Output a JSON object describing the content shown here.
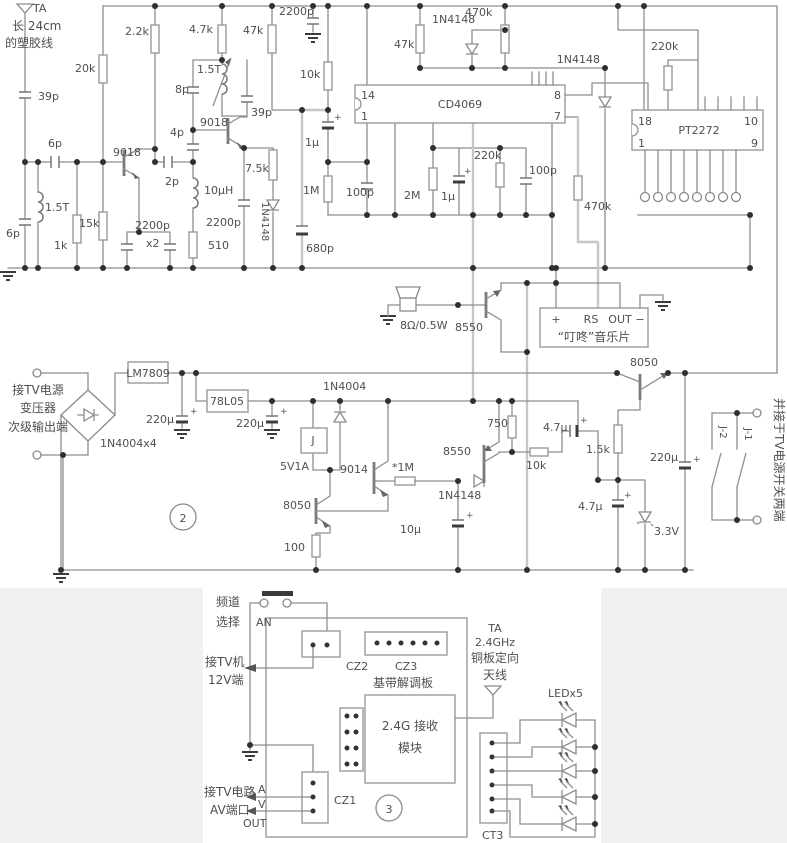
{
  "s1": {
    "ta": "TA",
    "ta2": "长 24cm",
    "ta3": "的塑胶线",
    "c39pa": "39p",
    "c6pa": "6p",
    "l15ta": "1.5T",
    "c6pb": "6p",
    "r1k": "1k",
    "r15k": "15k",
    "q9018a": "9018",
    "r20k": "20k",
    "r2k2": "2.2k",
    "c2200pa": "2200p",
    "x2": "x2",
    "c2p": "2p",
    "l10uh": "10µH",
    "r510": "510",
    "q9018b": "9018",
    "c4p": "4p",
    "c8p": "8p",
    "l15tb": "1.5T",
    "r4k7": "4.7k",
    "c39pb": "39p",
    "r47ka": "47k",
    "r7k5": "7.5k",
    "d4148d": "1N4148",
    "c2200pb": "2200p",
    "c2200pc": "2200p",
    "r10ka": "10k",
    "c1ua": "1µ",
    "r1m": "1M",
    "c680p": "680p",
    "c100pa": "100p",
    "r47kb": "47k",
    "d4148a": "1N4148",
    "r470ka": "470k",
    "ic1": "CD4069",
    "p14": "14",
    "p1": "1",
    "p8": "8",
    "p7": "7",
    "r2m": "2M",
    "c1ub": "1µ",
    "r220ka": "220k",
    "c100pb": "100p",
    "d4148b": "1N4148",
    "r470kb": "470k",
    "r220kb": "220k",
    "ic2": "PT2272",
    "p18": "18",
    "p1b": "1",
    "p10": "10",
    "p9": "9",
    "spk": "8Ω/0.5W",
    "q8550a": "8550",
    "mcp": "+",
    "mcrs": "RS",
    "mcout": "OUT",
    "mcm": "−",
    "mcname": "“叮咚”音乐片"
  },
  "s2": {
    "in1": "接TV电源",
    "in2": "变压器",
    "in3": "次级输出端",
    "bridge": "1N4004x4",
    "u1": "LM7809",
    "c220ua": "220µ",
    "u2": "78L05",
    "c220ub": "220µ",
    "num2": "2",
    "d4004": "1N4004",
    "relay": "J",
    "relayspec": "5V1A",
    "q9014": "9014",
    "r1ms": "*1M",
    "q8550b": "8550",
    "d4148c": "1N4148",
    "c10u": "10µ",
    "q8050a": "8050",
    "r100": "100",
    "r750": "750",
    "r10kb": "10k",
    "c4u7a": "4.7µ",
    "r1k5": "1.5k",
    "c220uc": "220µ",
    "c4u7b": "4.7µ",
    "dz": "3.3V",
    "q8050b": "8050",
    "j1": "J-1",
    "j2": "J-2",
    "note": "并接于TV电源开关两端"
  },
  "s3": {
    "ch1": "频道",
    "ch2": "选择",
    "an": "AN",
    "tv1": "接TV机",
    "tv2": "12V端",
    "cz2": "CZ2",
    "cz3": "CZ3",
    "board": "基带解调板",
    "mod1": "2.4G 接收",
    "mod2": "模块",
    "at1": "TA",
    "at2": "2.4GHz",
    "at3": "铜板定向",
    "at4": "天线",
    "av1": "接TV电路",
    "av2": "AV端口",
    "a": "A",
    "v": "V",
    "out": "OUT",
    "cz1": "CZ1",
    "num3": "3",
    "ct3": "CT3",
    "led": "LEDx5"
  }
}
